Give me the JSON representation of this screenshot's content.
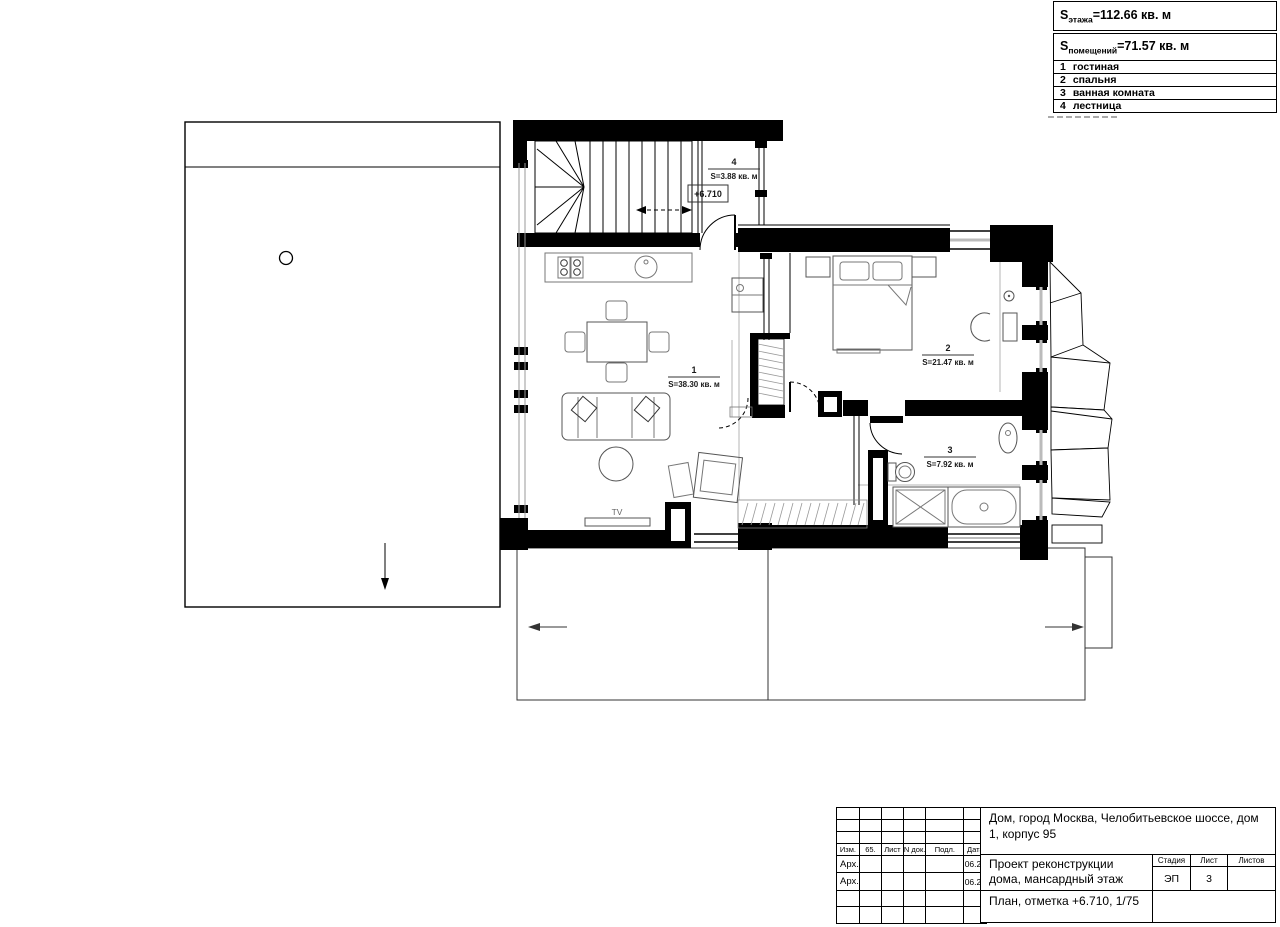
{
  "legend": {
    "floor_area": {
      "prefix": "S",
      "sub": "этажа",
      "rest": "=112.66 кв. м"
    },
    "rooms_area": {
      "prefix": "S",
      "sub": "помещений",
      "rest": "=71.57 кв. м"
    },
    "rooms": [
      {
        "num": "1",
        "name": "гостиная"
      },
      {
        "num": "2",
        "name": "спальня"
      },
      {
        "num": "3",
        "name": "ванная комната"
      },
      {
        "num": "4",
        "name": "лестница"
      }
    ]
  },
  "plan": {
    "rooms": [
      {
        "num": "1",
        "area": "S=38.30 кв. м"
      },
      {
        "num": "2",
        "area": "S=21.47 кв. м"
      },
      {
        "num": "3",
        "area": "S=7.92 кв. м"
      },
      {
        "num": "4",
        "area": "S=3.88 кв. м"
      }
    ],
    "elevation_mark": "+6.710",
    "tv_label": "TV"
  },
  "title_block": {
    "address": "Дом, город Москва, Челобитьевское шоссе, дом 1, корпус 95",
    "project": "Проект реконструкции дома, мансардный этаж",
    "sheet_title": "План, отметка +6.710, 1/75",
    "columns": [
      "Изм.",
      "65.",
      "Лист",
      "N док.",
      "Подл.",
      "Дата"
    ],
    "rows": [
      {
        "role": "Арх.",
        "date": "06.20"
      },
      {
        "role": "Арх.",
        "date": "06.20"
      }
    ],
    "stage_header": [
      "Стадия",
      "Лист",
      "Листов"
    ],
    "stage": "ЭП",
    "sheet_number": "3",
    "sheets_total": ""
  },
  "colors": {
    "wall": "#000000",
    "furniture": "#666666",
    "glass": "#bbbbbb"
  }
}
